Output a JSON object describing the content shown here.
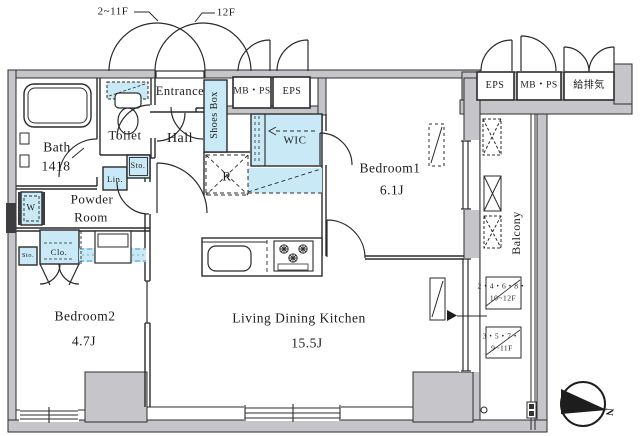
{
  "floor_labels": {
    "left": "2~11F",
    "right": "12F"
  },
  "rooms": {
    "entrance": "Entrance",
    "hall": "Hall",
    "shoes_box": "Shoes Box",
    "toilet": "Toilet",
    "bath": {
      "name": "Bath",
      "size": "1418"
    },
    "powder_room": {
      "line1": "Powder",
      "line2": "Room"
    },
    "wic": "WIC",
    "bedroom1": {
      "name": "Bedroom1",
      "size": "6.1J"
    },
    "bedroom2": {
      "name": "Bedroom2",
      "size": "4.7J"
    },
    "ldk": {
      "name": "Living Dining Kitchen",
      "size": "15.5J"
    },
    "balcony": "Balcony"
  },
  "utilities": {
    "left": {
      "mb_ps": "MB・PS",
      "eps": "EPS"
    },
    "right": {
      "eps": "EPS",
      "mb_ps": "MB・PS",
      "kyuhaiki": "給排気"
    }
  },
  "storage": {
    "washer": "W",
    "linen": "Lin.",
    "sto_hall": "Sto.",
    "sto_bedroom2": "Sto.",
    "closet": "Clo.",
    "refrigerator": "R"
  },
  "balcony_notes": {
    "note1": {
      "line1": "2・4・6・8・",
      "line2": "10~12F"
    },
    "note2": {
      "line1": "3・5・7・",
      "line2": "9~11F"
    }
  },
  "compass": {
    "north": "N"
  },
  "colors": {
    "fixture": "#c9e9f6",
    "wall": "#c6c6ca",
    "line": "#2b2b2b"
  }
}
